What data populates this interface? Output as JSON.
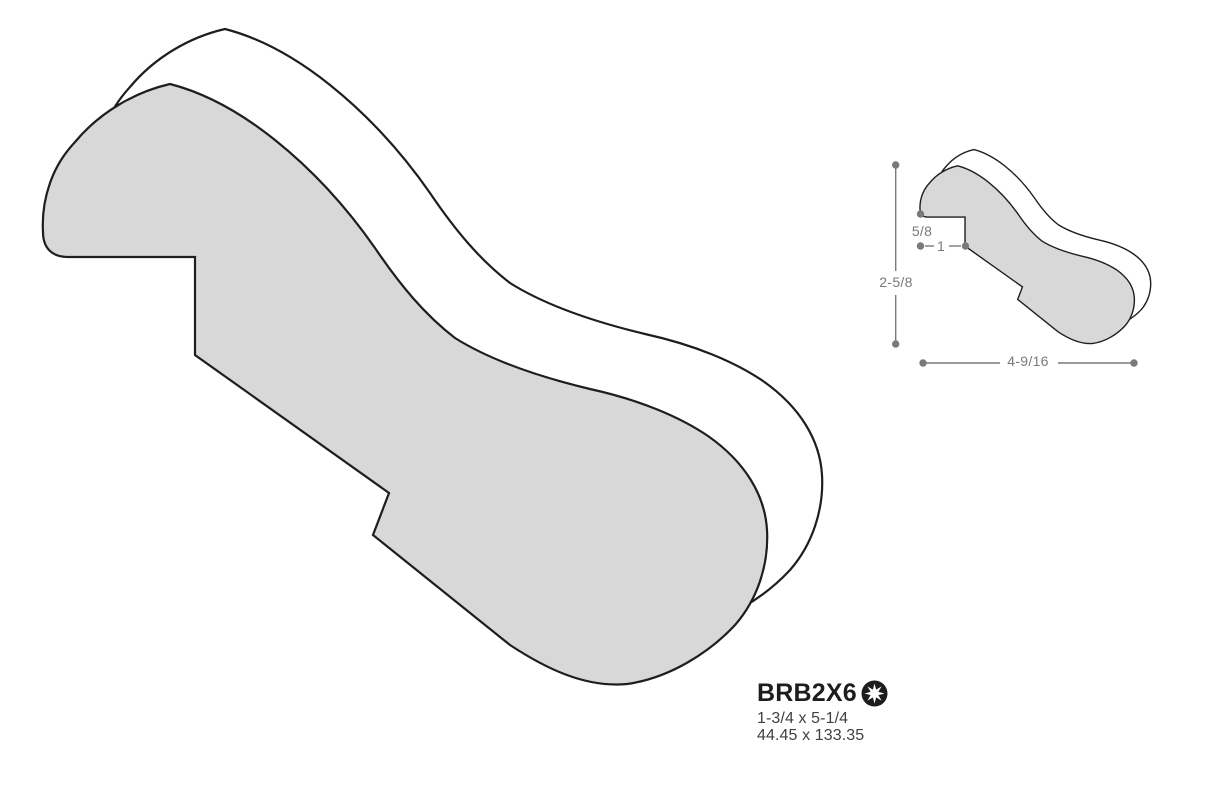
{
  "drawing": {
    "profile_fill": "#d8d8d8",
    "back_face_fill": "#ffffff",
    "outline_color": "#1e1e1e",
    "dimension_color": "#7a7a7a"
  },
  "dimensions": {
    "overall_height_label": "2-5/8",
    "lip_label": "5/8",
    "step_label": "1",
    "overall_width_label": "4-9/16"
  },
  "product": {
    "code": "BRB2X6",
    "badge_icon": "starburst-badge-icon",
    "size_imperial": "1-3/4 x 5-1/4",
    "size_metric": "44.45 x 133.35"
  }
}
